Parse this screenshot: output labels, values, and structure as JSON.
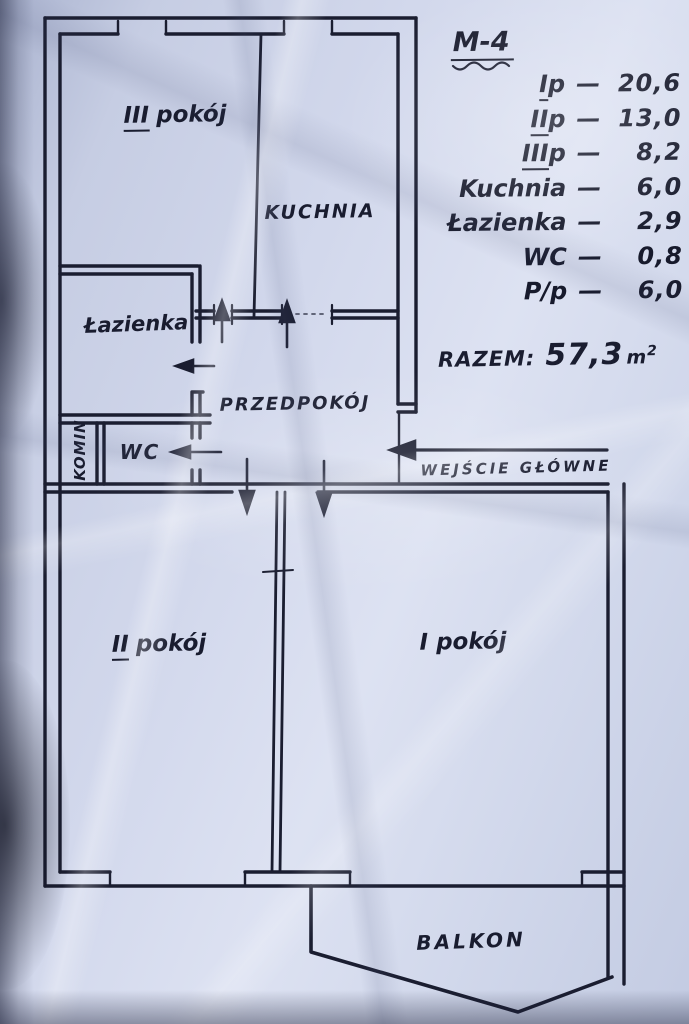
{
  "colors": {
    "paper": "#cdd4e8",
    "ink": "#1a1d30"
  },
  "header": {
    "title": "M-4"
  },
  "legend": {
    "dash": "—",
    "rows": [
      {
        "prefix": "I",
        "label": "p",
        "value": "20,6"
      },
      {
        "prefix": "II",
        "label": "p",
        "value": "13,0"
      },
      {
        "prefix": "III",
        "label": "p",
        "value": "8,2"
      },
      {
        "prefix": "",
        "label": "Kuchnia",
        "value": "6,0"
      },
      {
        "prefix": "",
        "label": "Łazienka",
        "value": "2,9"
      },
      {
        "prefix": "",
        "label": "WC",
        "value": "0,8"
      },
      {
        "prefix": "",
        "label": "P/p",
        "value": "6,0"
      }
    ],
    "total": {
      "label": "RAZEM:",
      "value": "57,3",
      "unit": "m",
      "sup": "2"
    }
  },
  "rooms": {
    "room3": {
      "prefix": "III",
      "name": "pokój"
    },
    "kitchen": {
      "prefix": "",
      "name": "KUCHNIA"
    },
    "bathroom": {
      "prefix": "",
      "name": "Łazienka"
    },
    "wc": {
      "prefix": "",
      "name": "WC"
    },
    "chimney": {
      "prefix": "",
      "name": "KOMIN"
    },
    "hall": {
      "prefix": "",
      "name": "PRZEDPOKÓJ"
    },
    "room2": {
      "prefix": "II",
      "name": "pokój"
    },
    "room1": {
      "prefix": "",
      "name": "I pokój"
    },
    "balcony": {
      "prefix": "",
      "name": "BALKON"
    }
  },
  "annotations": {
    "entrance": "WEJŚCIE GŁÓWNE"
  }
}
